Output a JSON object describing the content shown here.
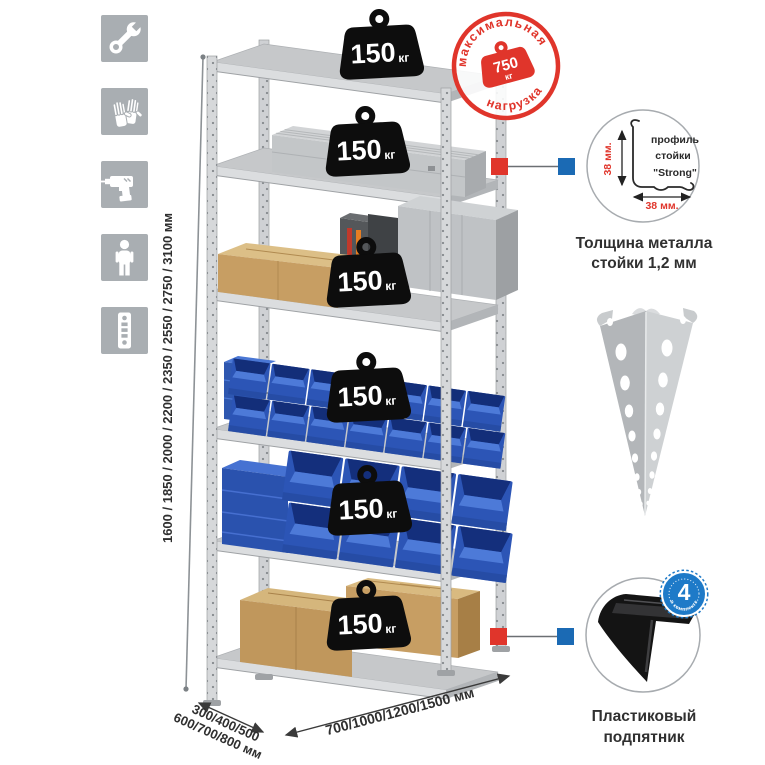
{
  "stamp": {
    "arc_top": "максимальная",
    "arc_bottom": "нагрузка",
    "weight_value": "750",
    "weight_unit": "кг"
  },
  "badges": {
    "value": "150",
    "unit": "кг",
    "count": 6
  },
  "dimensions": {
    "height": "1600 / 1850 / 2000 / 2200 / 2350 / 2550 / 2750 / 3100 мм",
    "depth_line1": "300/400/500",
    "depth_line2": "600/700/800 мм",
    "width": "700/1000/1200/1500 мм"
  },
  "profile_detail": {
    "label_line1": "профиль",
    "label_line2": "стойки",
    "label_line3": "\"Strong\"",
    "dim_vertical": "38 мм.",
    "dim_horizontal": "38 мм.",
    "caption_line1": "Толщина металла",
    "caption_line2": "стойки 1,2 мм"
  },
  "foot_detail": {
    "badge_count": "4",
    "badge_ring_text": "в комплекте",
    "caption_line1": "Пластиковый",
    "caption_line2": "подпятник"
  },
  "sidebar": {
    "icons": [
      {
        "name": "wrench"
      },
      {
        "name": "gloves"
      },
      {
        "name": "drill"
      },
      {
        "name": "person"
      },
      {
        "name": "rack-post"
      }
    ]
  },
  "colors": {
    "accent_red": "#e0352b",
    "connector_blue": "#1b6ab4",
    "count_badge_blue": "#1e7ac8",
    "bin_blue": "#2c55b6",
    "metal_gray": "#c6c8ca",
    "icon_tile_gray": "#a9aeb2",
    "weight_black": "#0d0d0d"
  }
}
